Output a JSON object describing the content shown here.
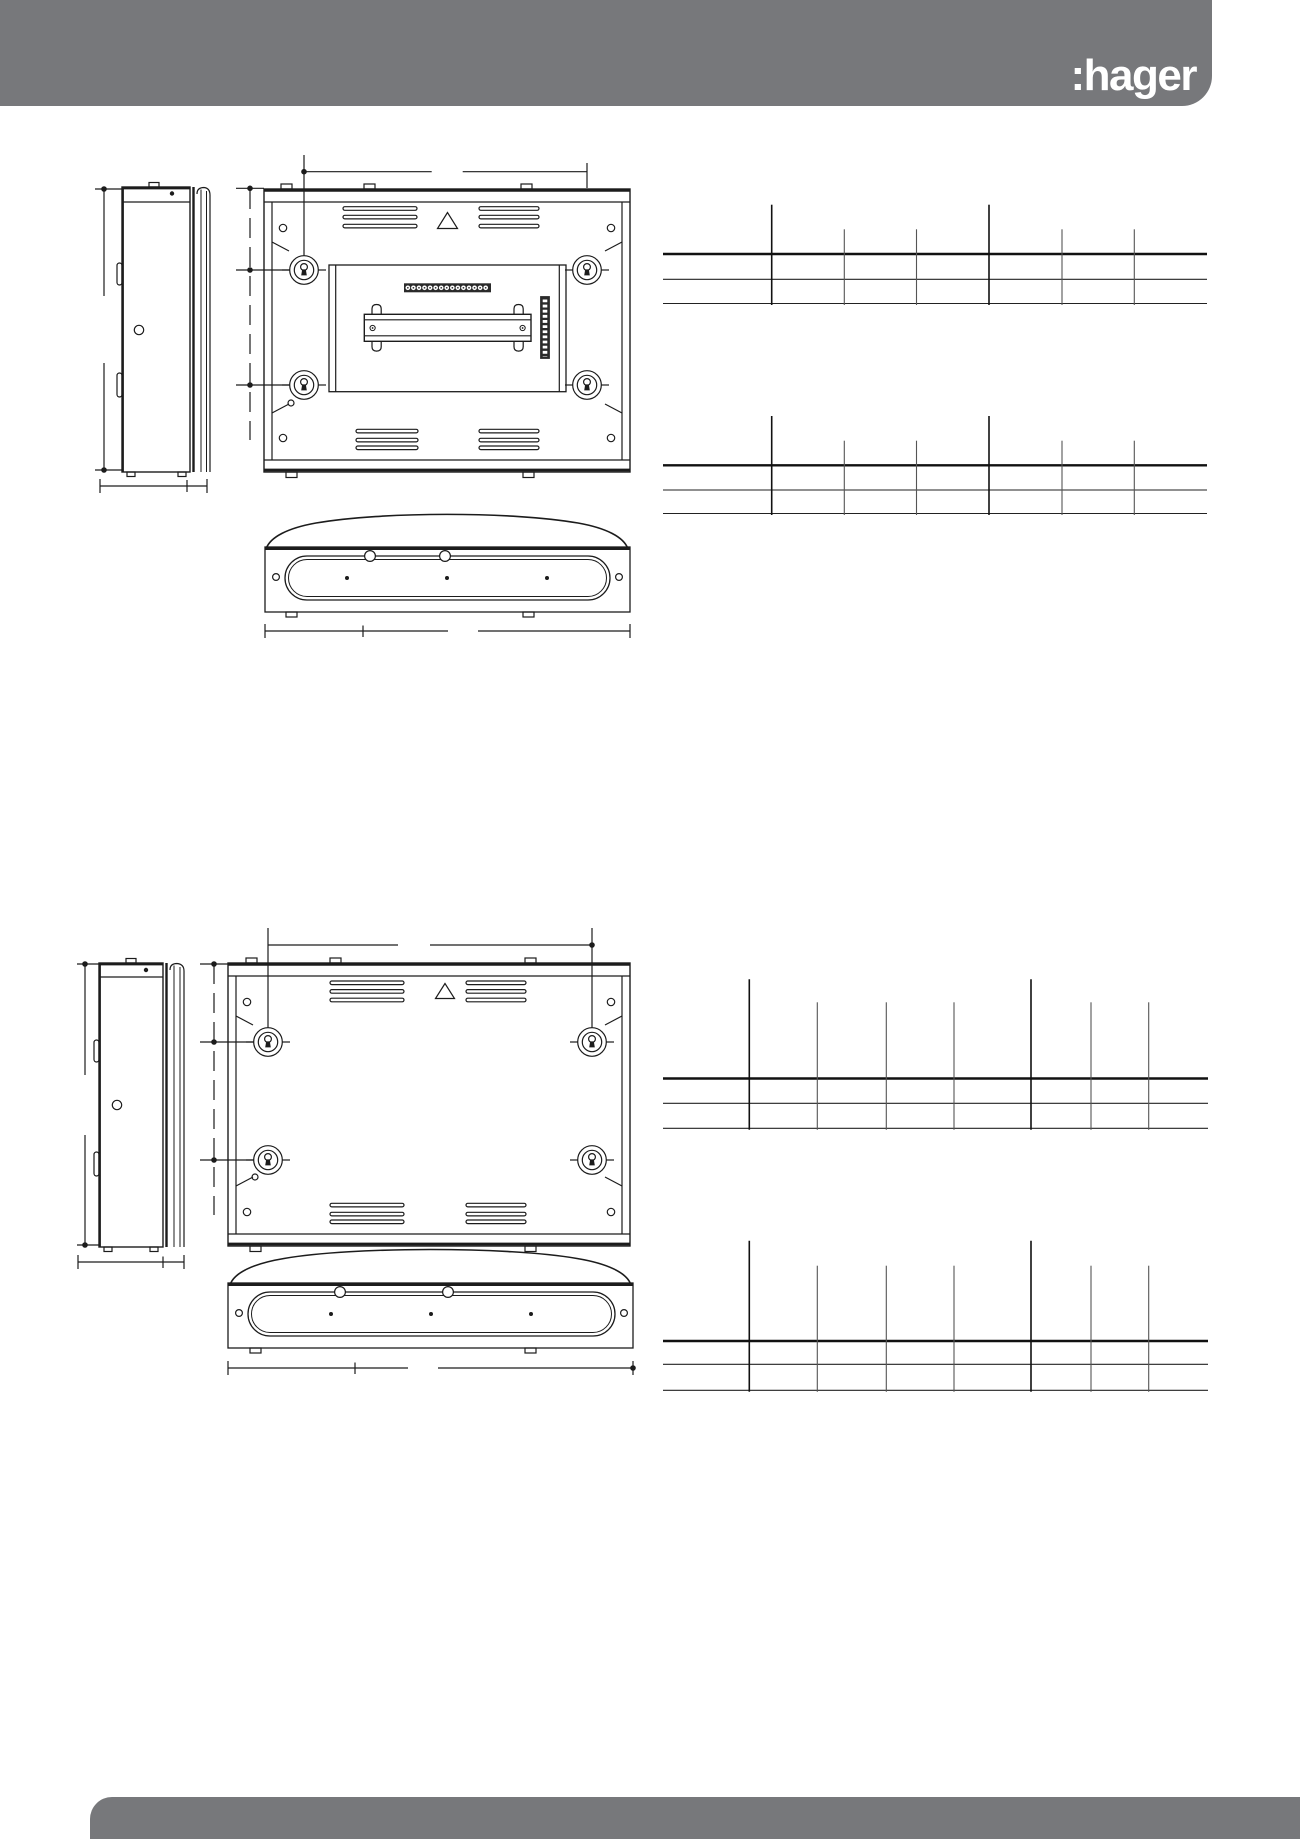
{
  "page": {
    "width": 1300,
    "height": 1839,
    "background": "#ffffff",
    "line_color": "#1c1c1c"
  },
  "header": {
    "logo_text": ":hager",
    "bar_color": "#77787B",
    "logo_color": "#ffffff"
  },
  "footer": {
    "bar_color": "#77787B"
  },
  "figures": [
    {
      "id": "enclosure-1",
      "views": [
        "side-view",
        "rear-view",
        "bottom-view"
      ],
      "icons": [
        "keyhole-mount-icon",
        "vent-slots",
        "warning-triangle-icon",
        "din-rail",
        "terminal-strip",
        "connector-strip",
        "gland-plate-slot"
      ]
    },
    {
      "id": "enclosure-2",
      "views": [
        "side-view",
        "rear-view",
        "bottom-view"
      ],
      "icons": [
        "keyhole-mount-icon",
        "vent-slots",
        "warning-triangle-icon",
        "gland-plate-slot"
      ]
    }
  ],
  "tables": [
    {
      "name": "dimension-table-1",
      "x_start": 663,
      "x_end": 1207,
      "row_lines": [
        254,
        279.3,
        303.5
      ],
      "tick_top_tall": 204.7,
      "tick_top_short": 229.3,
      "columns": [
        {
          "x": 771.7,
          "tall": true
        },
        {
          "x": 844.3,
          "tall": false
        },
        {
          "x": 916.5,
          "tall": false
        },
        {
          "x": 989,
          "tall": true
        },
        {
          "x": 1062,
          "tall": false
        },
        {
          "x": 1134.3,
          "tall": false
        }
      ],
      "cells_text": ""
    },
    {
      "name": "dimension-table-2",
      "x_start": 663,
      "x_end": 1207,
      "row_lines": [
        465.3,
        490,
        513.5
      ],
      "tick_top_tall": 416,
      "tick_top_short": 440.7,
      "columns": [
        {
          "x": 771.7,
          "tall": true
        },
        {
          "x": 844.3,
          "tall": false
        },
        {
          "x": 916.5,
          "tall": false
        },
        {
          "x": 989,
          "tall": true
        },
        {
          "x": 1062,
          "tall": false
        },
        {
          "x": 1134.3,
          "tall": false
        }
      ],
      "cells_text": ""
    },
    {
      "name": "dimension-table-3",
      "x_start": 663,
      "x_end": 1208,
      "row_lines": [
        1078.5,
        1103.3,
        1128.3
      ],
      "tick_top_tall": 979.3,
      "tick_top_short": 1002.3,
      "columns": [
        {
          "x": 749.3,
          "tall": true
        },
        {
          "x": 817.3,
          "tall": false
        },
        {
          "x": 886.3,
          "tall": false
        },
        {
          "x": 954,
          "tall": false
        },
        {
          "x": 1031,
          "tall": true
        },
        {
          "x": 1091,
          "tall": false
        },
        {
          "x": 1148.7,
          "tall": false
        }
      ],
      "cells_text": ""
    },
    {
      "name": "dimension-table-4",
      "x_start": 663,
      "x_end": 1208,
      "row_lines": [
        1341,
        1364.3,
        1390.3
      ],
      "tick_top_tall": 1240.7,
      "tick_top_short": 1265.7,
      "columns": [
        {
          "x": 749.3,
          "tall": true
        },
        {
          "x": 817.3,
          "tall": false
        },
        {
          "x": 886.3,
          "tall": false
        },
        {
          "x": 954,
          "tall": false
        },
        {
          "x": 1031,
          "tall": true
        },
        {
          "x": 1091,
          "tall": false
        },
        {
          "x": 1148.7,
          "tall": false
        }
      ],
      "cells_text": ""
    }
  ]
}
